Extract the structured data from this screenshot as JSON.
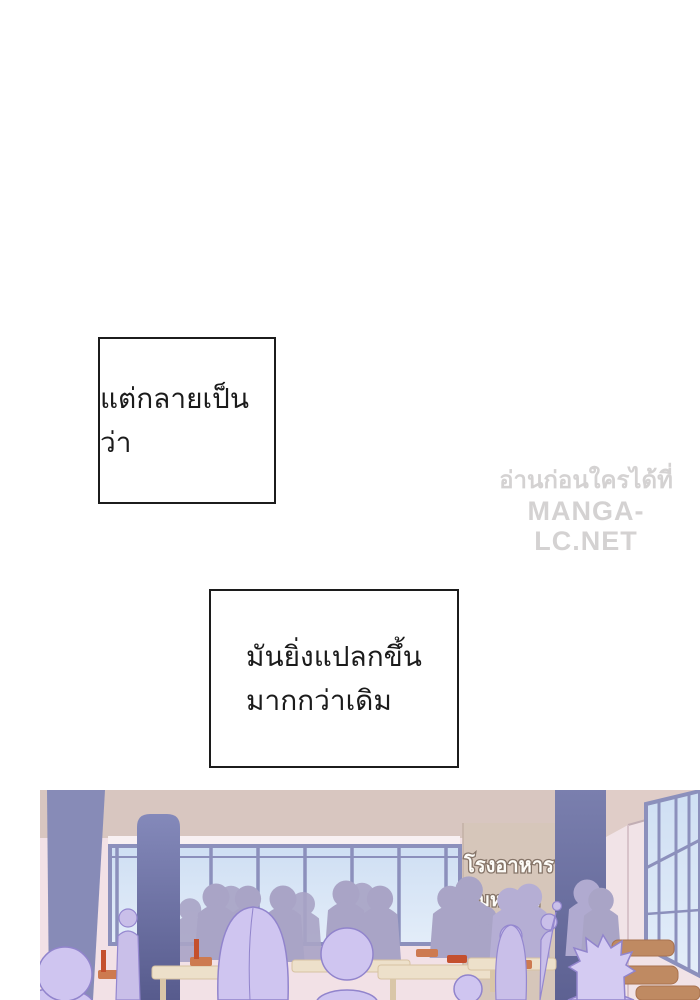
{
  "page": {
    "background": "#ffffff"
  },
  "narration": [
    {
      "text": "แต่กลายเป็นว่า"
    },
    {
      "lines": [
        "มันยิ่งแปลกขึ้น",
        "มากกว่าเดิม"
      ]
    }
  ],
  "watermark": {
    "line1": "อ่านก่อนใครได้ที่",
    "line2": "MANGA-LC.NET"
  },
  "scene": {
    "sign": {
      "line1": "โรงอาหาร",
      "line2": "มหา'ลัย"
    },
    "colors": {
      "wall_pink": "#f2e1e6",
      "band_beige": "#d8c6c0",
      "sill_white": "#f8f0f2",
      "pillar": "#878bb7",
      "pillar_dark_top": "#7a7fae",
      "pillar_dark_bottom": "#5d6192",
      "window_pane": "#d9e5f5",
      "window_frame": "#8c90bc",
      "sign_bg": "#d6c6ba",
      "sign_text": "#fdfcf8",
      "sign_text_outline": "#857468",
      "crowd_back": "#a9a4c6",
      "crowd_back_light": "#b5aed4",
      "crowd_front": "#cfc5f0",
      "crowd_front_stroke": "#9184cc",
      "table": "#ede0ca",
      "chair_orange": "#cd7a50",
      "chair_red": "#c4502e",
      "chair_brown": "#bf8a62"
    }
  }
}
